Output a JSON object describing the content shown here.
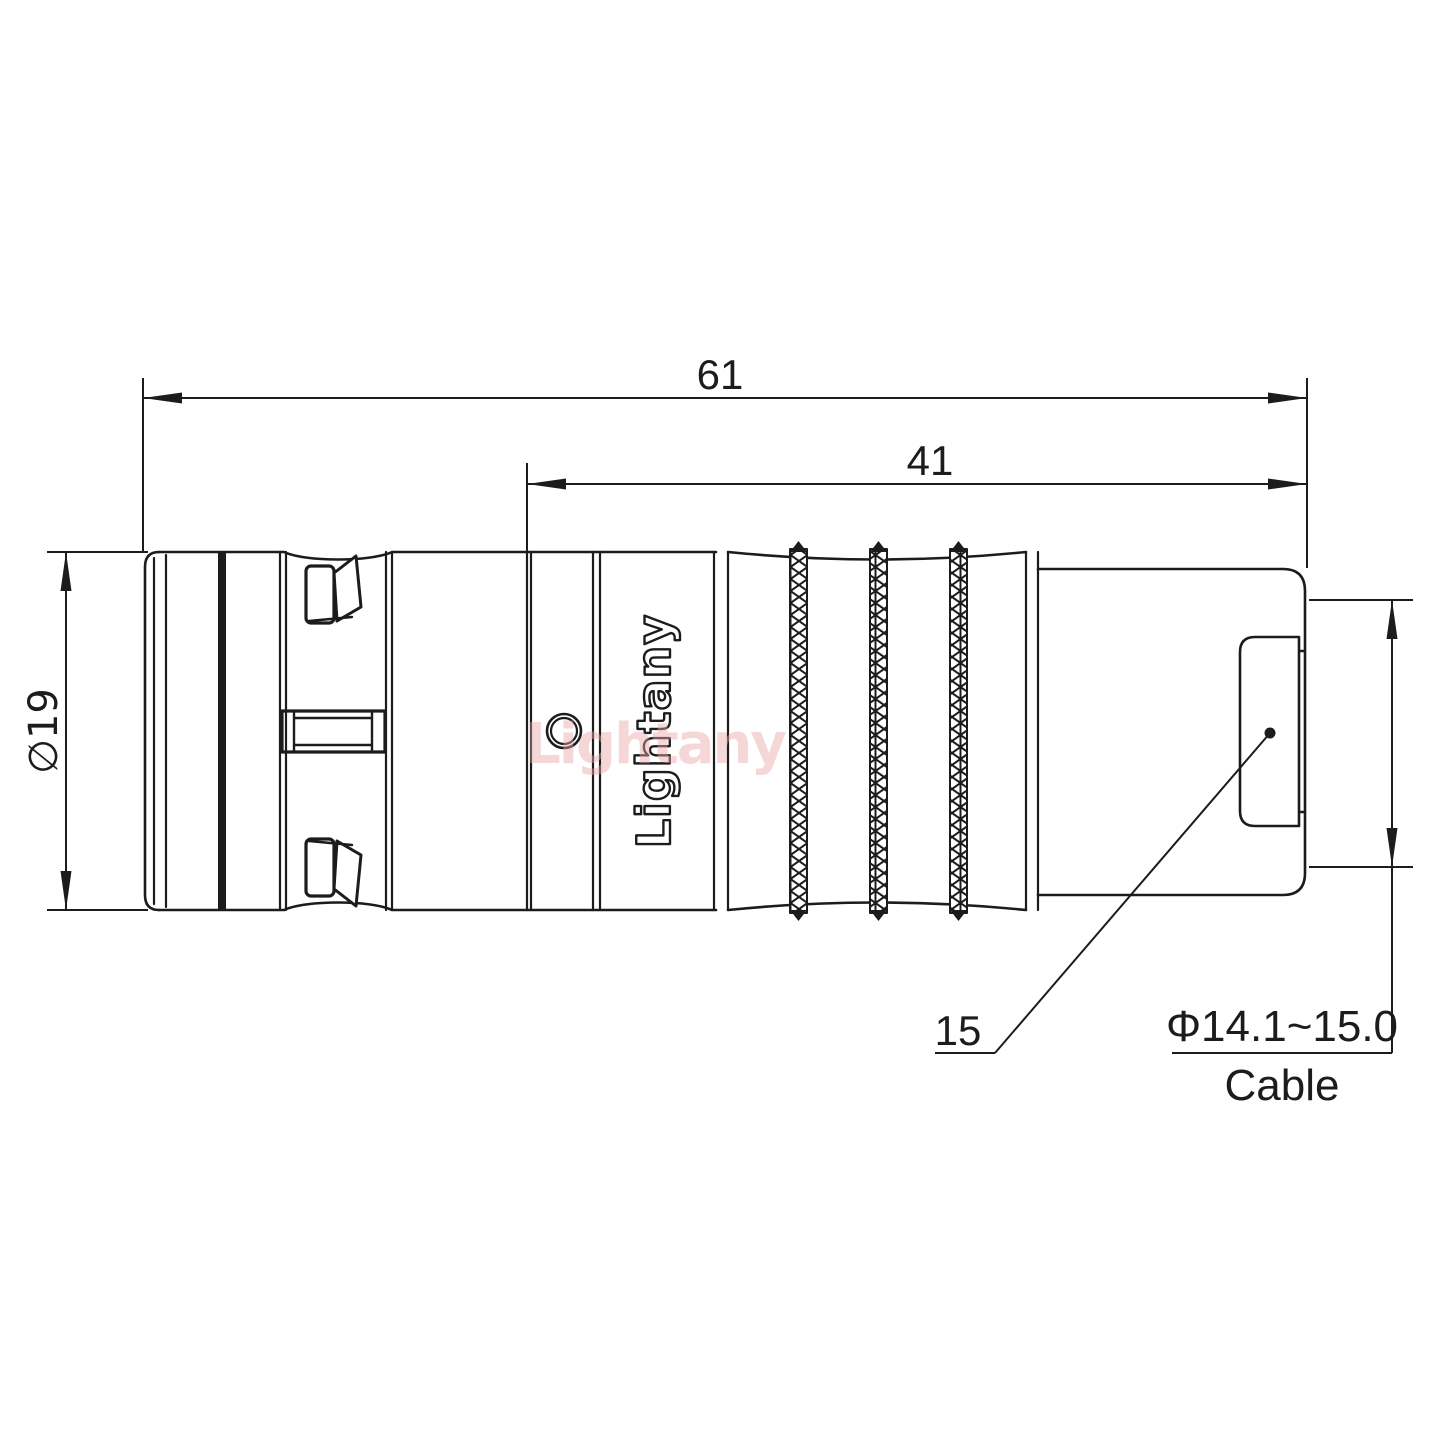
{
  "drawing": {
    "type": "technical-drawing-connector-side-view",
    "dimensions": {
      "total_length": "61",
      "barrel_length": "41",
      "body_diameter": "∅19",
      "nut_size": "15",
      "cable_range": "Φ14.1~15.0",
      "cable_label": "Cable"
    },
    "branding": {
      "body_text": "Lightany",
      "watermark_text": "Lightany"
    },
    "colors": {
      "line": "#1c1c1c",
      "watermark": "#eba8a8",
      "background": "#ffffff"
    }
  }
}
